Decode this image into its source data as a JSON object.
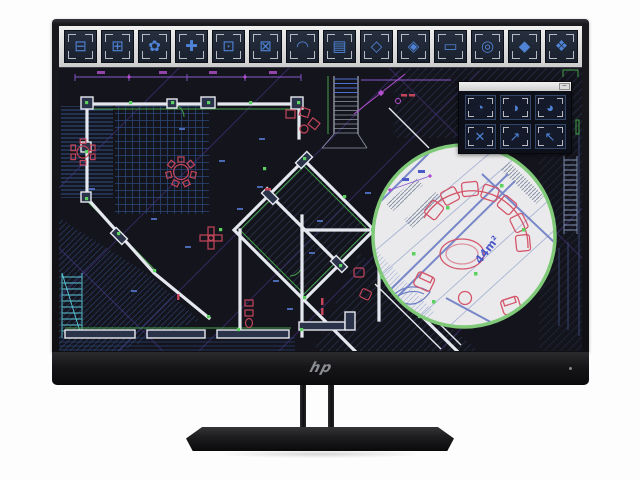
{
  "monitor": {
    "brand_logo": "hp"
  },
  "screen": {
    "toolbar": {
      "buttons": [
        {
          "name": "bed-block-tool",
          "glyph": "⊟"
        },
        {
          "name": "cabinet-block-tool",
          "glyph": "⊞"
        },
        {
          "name": "plant-block-tool",
          "glyph": "✿"
        },
        {
          "name": "table-group-block-tool",
          "glyph": "✚"
        },
        {
          "name": "toilet-block-tool",
          "glyph": "⊡"
        },
        {
          "name": "bathtub-block-tool",
          "glyph": "⊠"
        },
        {
          "name": "arch-block-tool",
          "glyph": "◠"
        },
        {
          "name": "shelf-block-tool",
          "glyph": "▤"
        },
        {
          "name": "rotate-block-tool",
          "glyph": "◇"
        },
        {
          "name": "rotate-copy-block-tool",
          "glyph": "◈"
        },
        {
          "name": "ruler-tool",
          "glyph": "▭"
        },
        {
          "name": "center-snap-tool",
          "glyph": "◎"
        },
        {
          "name": "solid-fill-tool",
          "glyph": "◆"
        },
        {
          "name": "hatch-fill-tool",
          "glyph": "❖"
        }
      ]
    },
    "palette": {
      "minimize_label": "–",
      "buttons": [
        {
          "name": "round-block-1-tool",
          "glyph": "◔"
        },
        {
          "name": "round-block-2-tool",
          "glyph": "◑"
        },
        {
          "name": "round-block-3-tool",
          "glyph": "◕"
        },
        {
          "name": "scale-all-tool",
          "glyph": "✕"
        },
        {
          "name": "stretch-ne-tool",
          "glyph": "↗"
        },
        {
          "name": "stretch-nw-tool",
          "glyph": "↖"
        }
      ]
    },
    "magnifier": {
      "area_label": "44m²"
    },
    "colors": {
      "canvas_bg": "#14141d",
      "toolbar_bg": "#d8d8d8",
      "tool_glyph": "#4f83d6",
      "bracket": "#b6bac2",
      "wall": "#e6e8ef",
      "wall_fill": "#2a3349",
      "green": "#43a047",
      "snap": "#5ad15e",
      "red": "#c4455a",
      "purple": "#8a5ad0",
      "magenta": "#b44fd0",
      "cyan": "#5bc8d8",
      "mag_bg": "#eaeaec",
      "mag_ring": "#7fc978",
      "mag_red": "#d4556a",
      "label_blue": "#4a58c8"
    }
  }
}
